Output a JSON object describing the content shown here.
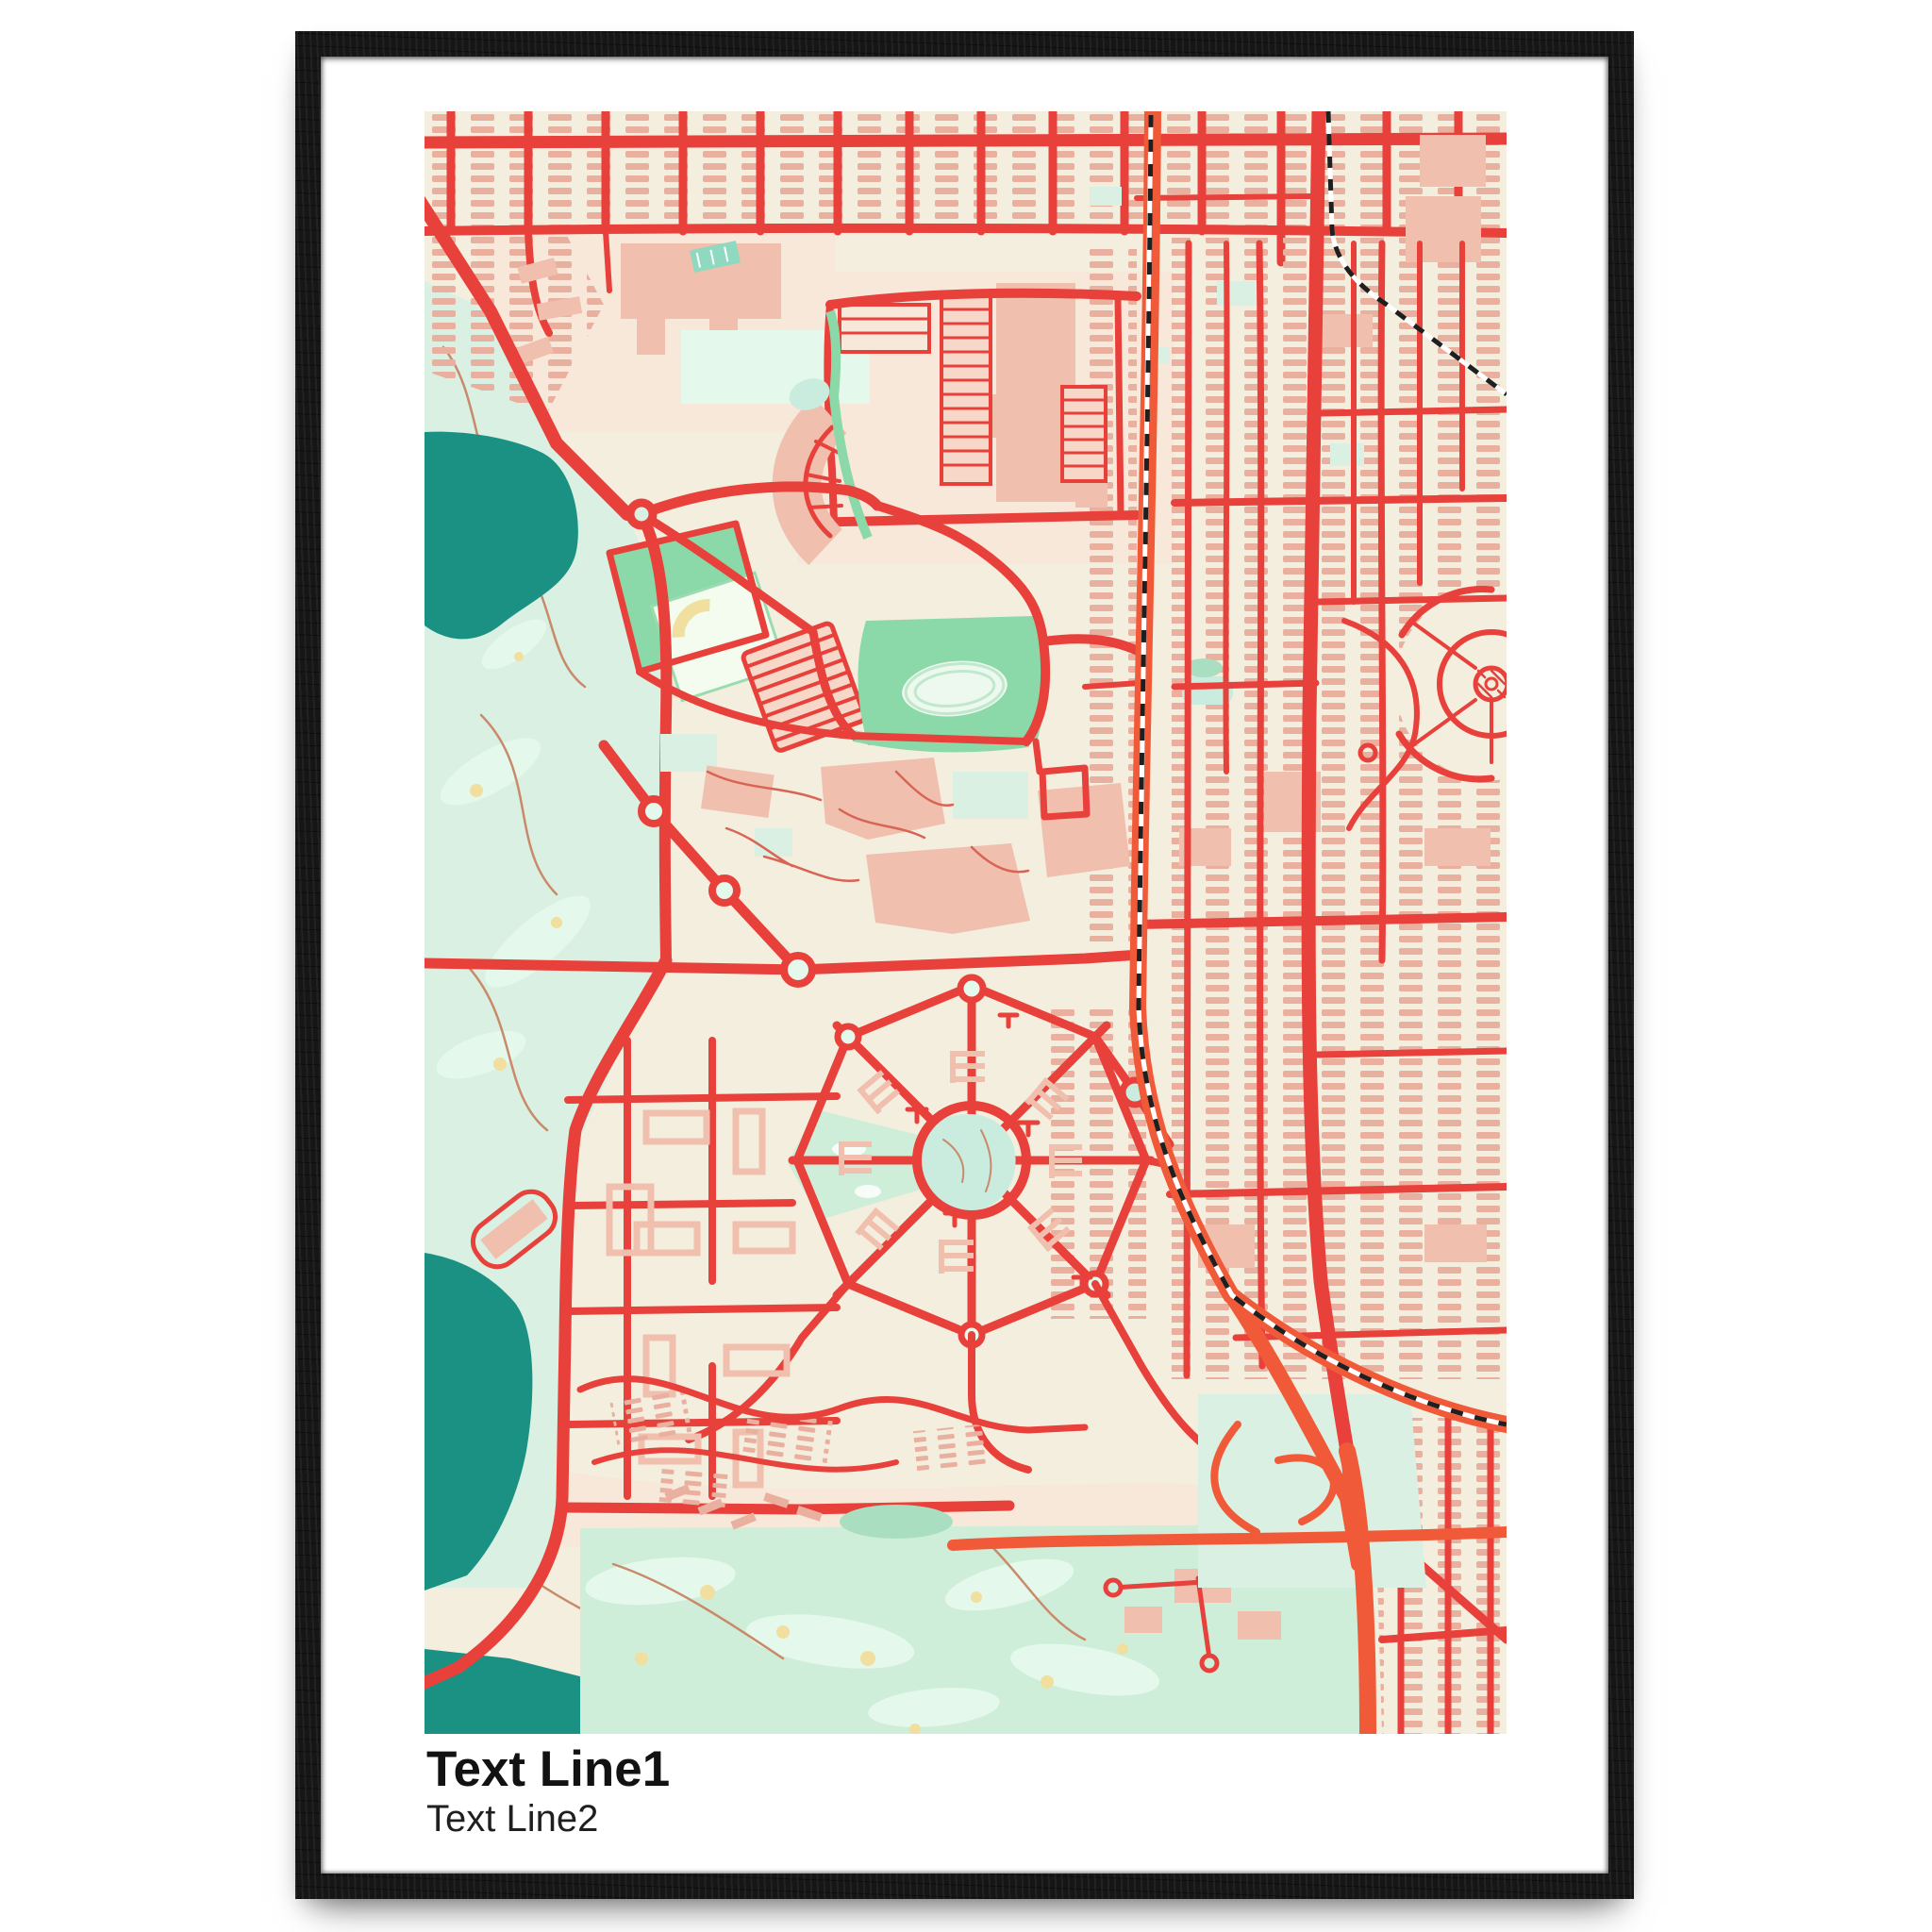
{
  "poster": {
    "text_line1": "Text Line1",
    "text_line2": "Text Line2"
  },
  "map": {
    "style_name": "blossom-style city map print",
    "features": [
      "residential street grid",
      "row houses",
      "golf course",
      "lakes",
      "athletics stadium",
      "running track",
      "practice field",
      "university campus",
      "shopping mall with parking lots",
      "radial garden district",
      "central pond",
      "crescent estate",
      "arterial road",
      "highway",
      "railway with junction",
      "motorway interchange",
      "circular estate",
      "beach strip",
      "fairways",
      "sand bunkers"
    ]
  },
  "colors": {
    "frame": "#161616",
    "mat": "#ffffff",
    "map_bg": "#f4eede",
    "zone_pink": "#f8e8d9",
    "road": "#e8403a",
    "highway": "#f15a38",
    "water": "#1b9184",
    "aqua": "#c9ecdf",
    "mint": "#d9f0e2",
    "mint_light": "#e5f8ec",
    "mint_bottom": "#cfeeda",
    "green": "#8bd9a8",
    "green_soft": "#a9dfc0",
    "building": "#f0bfae",
    "building_light": "#f6d7c8",
    "house": "#e9b0a0",
    "sand": "#f0df9e",
    "rail": "#1f1f1f",
    "path_thin": "#c98a6a",
    "path_campus": "#d96455",
    "ink": "#121212"
  }
}
